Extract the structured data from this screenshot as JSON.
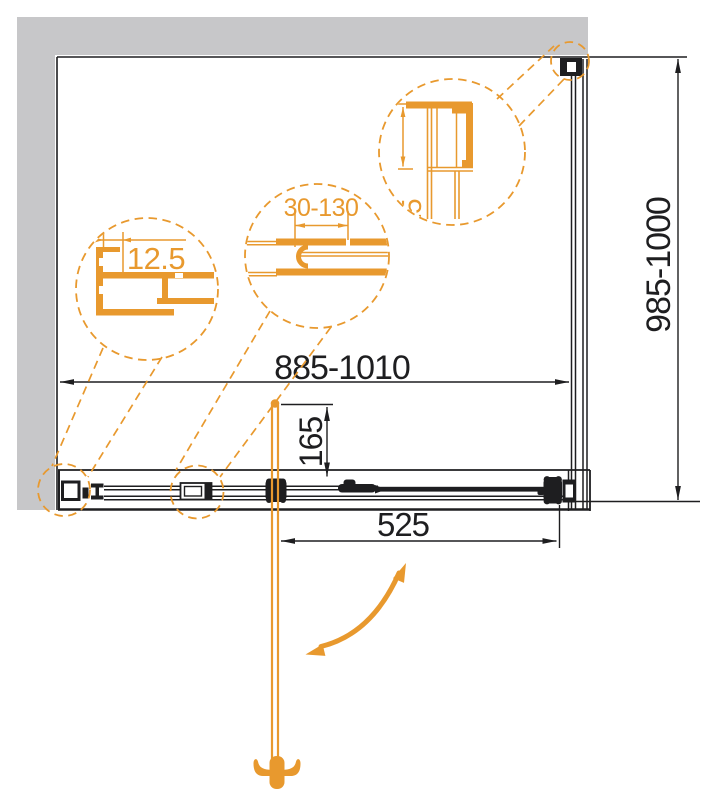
{
  "diagram": {
    "type": "shower-enclosure-technical-drawing",
    "dimension_labels": {
      "overall_width": "885-1010",
      "side_panel_depth": "985-1000",
      "door_width": "525",
      "handle_offset": "165"
    },
    "detail_labels": {
      "wall_profile_adjustment": "12.5",
      "profile_adjustment_range": "30-130",
      "corner_profile_size": "15"
    },
    "colors": {
      "accent": "#E8992E",
      "wall": "#C7C7C9",
      "ink": "#1E1E20",
      "paper": "#FFFFFF"
    }
  }
}
